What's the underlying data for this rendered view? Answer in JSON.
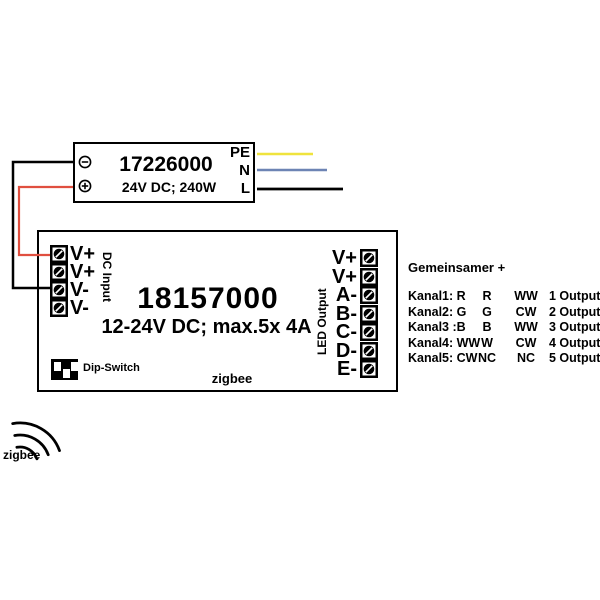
{
  "psu": {
    "model": "17226000",
    "spec": "24V DC; 240W",
    "mains": {
      "pe": "PE",
      "n": "N",
      "l": "L"
    }
  },
  "controller": {
    "model": "18157000",
    "spec": "12-24V DC; max.5x 4A",
    "dc_input_label": "DC Input",
    "led_output_label": "LED Output",
    "dip_switch_label": "Dip-Switch",
    "zigbee_label": "zigbee",
    "input_terminals": [
      "V+",
      "V+",
      "V-",
      "V-"
    ],
    "output_terminals": [
      "V+",
      "V+",
      "A-",
      "B-",
      "C-",
      "D-",
      "E-"
    ]
  },
  "legend": {
    "header": "Gemeinsamer +",
    "rows": [
      {
        "c1": "Kanal1: R",
        "c2": "R",
        "c3": "WW",
        "c4": "1 Output"
      },
      {
        "c1": "Kanal2: G",
        "c2": "G",
        "c3": "CW",
        "c4": "2 Output"
      },
      {
        "c1": "Kanal3 :B",
        "c2": "B",
        "c3": "WW",
        "c4": "3 Output"
      },
      {
        "c1": "Kanal4: WW",
        "c2": "W",
        "c3": "CW",
        "c4": "4 Output"
      },
      {
        "c1": "Kanal5: CW",
        "c2": "NC",
        "c3": "NC",
        "c4": "5 Output"
      }
    ]
  },
  "antenna_label": "zigbee",
  "colors": {
    "pe_wire": "#efe33d",
    "n_wire": "#6d84b4",
    "l_wire": "#000000",
    "plus_wire": "#e04f3f",
    "minus_wire": "#000000",
    "outline": "#000000"
  }
}
